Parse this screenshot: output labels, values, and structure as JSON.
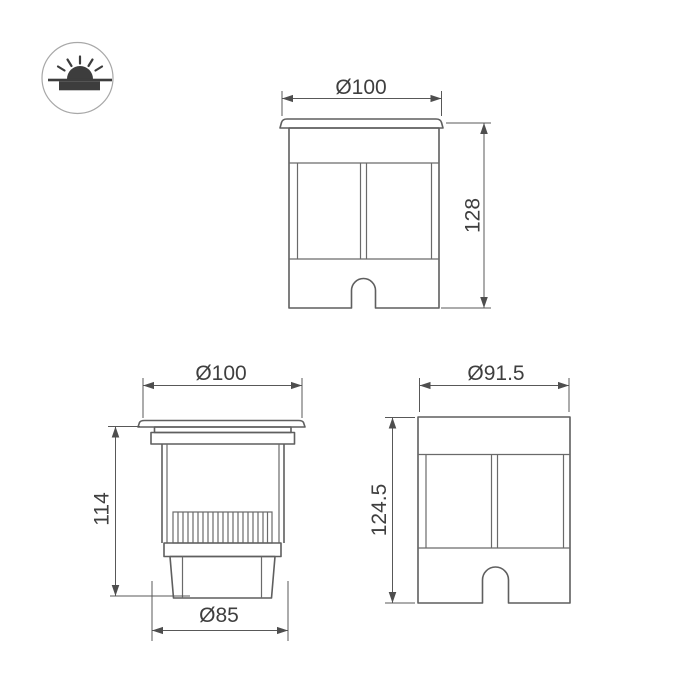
{
  "title": "Recessed ground luminaire dimension drawing",
  "colors": {
    "background": "#ffffff",
    "outline": "#5f5f5f",
    "dimension_line": "#585858",
    "label_text": "#3f3f3f",
    "icon_glyph": "#3d3d3d",
    "icon_ring": "#a8a8a8"
  },
  "icon": {
    "label": "recessed-ground-light-symbol"
  },
  "views": {
    "front": {
      "name": "front view with flange",
      "dims": {
        "width": "Ø100",
        "height": "128"
      }
    },
    "section": {
      "name": "side section view",
      "dims": {
        "width": "Ø100",
        "height": "114",
        "base": "Ø85"
      }
    },
    "housing": {
      "name": "inner housing view",
      "dims": {
        "width": "Ø91.5",
        "height": "124.5"
      }
    }
  }
}
